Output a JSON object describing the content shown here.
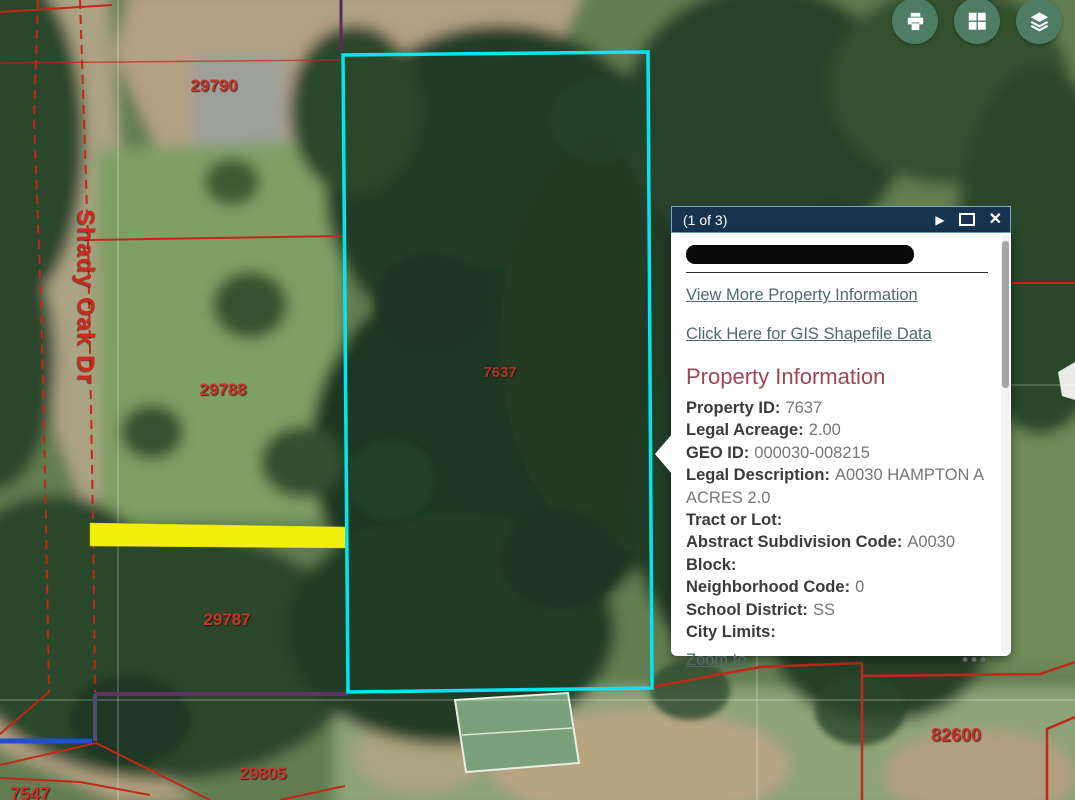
{
  "map": {
    "street_label": "Shady Oak Dr",
    "parcel_labels": [
      {
        "text": "29790"
      },
      {
        "text": "29788"
      },
      {
        "text": "29787"
      },
      {
        "text": "29805"
      },
      {
        "text": "82600"
      },
      {
        "text": "7547"
      },
      {
        "text": "7637"
      }
    ]
  },
  "toolbar": {
    "print_icon": "printer",
    "grid_icon": "basemap-grid",
    "layers_icon": "layers"
  },
  "popup": {
    "title": "(1 of 3)",
    "icons": {
      "next": "▶",
      "close": "✕",
      "ellipsis": "•••"
    },
    "view_more_link": "View More Property Information",
    "shapefile_link": "Click Here for GIS Shapefile Data",
    "heading": "Property Information",
    "fields": [
      {
        "label": "Property ID:",
        "value": "7637"
      },
      {
        "label": "Legal Acreage:",
        "value": "2.00"
      },
      {
        "label": "GEO ID:",
        "value": "000030-008215"
      },
      {
        "label": "Legal Description:",
        "value": "A0030 HAMPTON A ACRES 2.0"
      },
      {
        "label": "Tract or Lot:",
        "value": ""
      },
      {
        "label": "Abstract Subdivision Code:",
        "value": "A0030"
      },
      {
        "label": "Block:",
        "value": ""
      },
      {
        "label": "Neighborhood Code:",
        "value": "0"
      },
      {
        "label": "School District:",
        "value": "SS"
      },
      {
        "label": "City Limits:",
        "value": ""
      }
    ],
    "zoom_to_link": "Zoom to"
  },
  "colors": {
    "button_green": "#4e7d63",
    "cyan_highlight": "#00e7f2",
    "selection_yellow": "#f3ee0b",
    "parcel_line_red": "#c0281a",
    "label_red": "#c5352a",
    "titlebar_navy": "#173350",
    "link_teal": "#4e6b6b",
    "heading_maroon": "#9c4750"
  }
}
